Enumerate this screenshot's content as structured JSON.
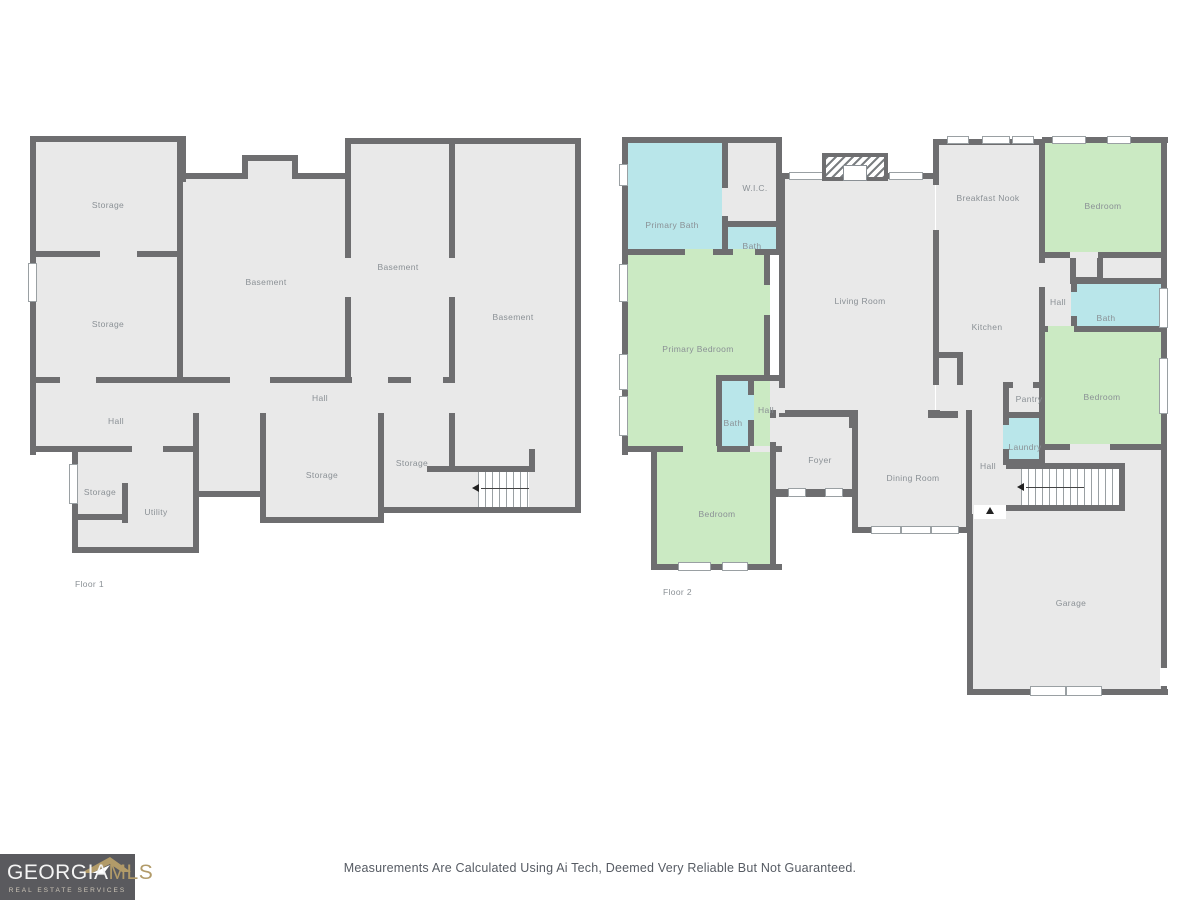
{
  "colors": {
    "wall": "#6e6e70",
    "room": "#e9e9e9",
    "bedroom": "#cbeac3",
    "bath": "#b9e6ea",
    "window_border": "#9aa0a3",
    "label": "#8a9095",
    "logo_bg": "#5a5a5e",
    "logo_gold": "#b29b69",
    "disclaimer_text": "#565b63"
  },
  "floor1": {
    "caption": "Floor 1",
    "rooms": {
      "storage_tl": "Storage",
      "storage_ml": "Storage",
      "basement_c": "Basement",
      "basement_m": "Basement",
      "basement_r": "Basement",
      "hall_main": "Hall",
      "hall_left": "Hall",
      "storage_small_l": "Storage",
      "utility": "Utility",
      "storage_big": "Storage",
      "storage_small_r": "Storage"
    }
  },
  "floor2": {
    "caption": "Floor 2",
    "rooms": {
      "primary_bath": "Primary Bath",
      "wic": "W.I.C.",
      "bath_upper": "Bath",
      "primary_bedroom": "Primary Bedroom",
      "bath_inner": "Bath",
      "hall_pocket": "Hall",
      "bedroom_bl": "Bedroom",
      "living": "Living Room",
      "foyer": "Foyer",
      "dining": "Dining Room",
      "breakfast": "Breakfast Nook",
      "kitchen": "Kitchen",
      "pantry": "Pantry",
      "laundry": "Laundry",
      "hall_garage": "Hall",
      "garage": "Garage",
      "bedroom_tr": "Bedroom",
      "hall_right": "Hall",
      "bath_right": "Bath",
      "bedroom_mr": "Bedroom"
    }
  },
  "footer": {
    "logo_georgia": "GEORGIA",
    "logo_mls": "MLS",
    "logo_tagline": "REAL ESTATE SERVICES",
    "disclaimer": "Measurements Are Calculated Using Ai Tech, Deemed Very Reliable But Not Guaranteed."
  }
}
